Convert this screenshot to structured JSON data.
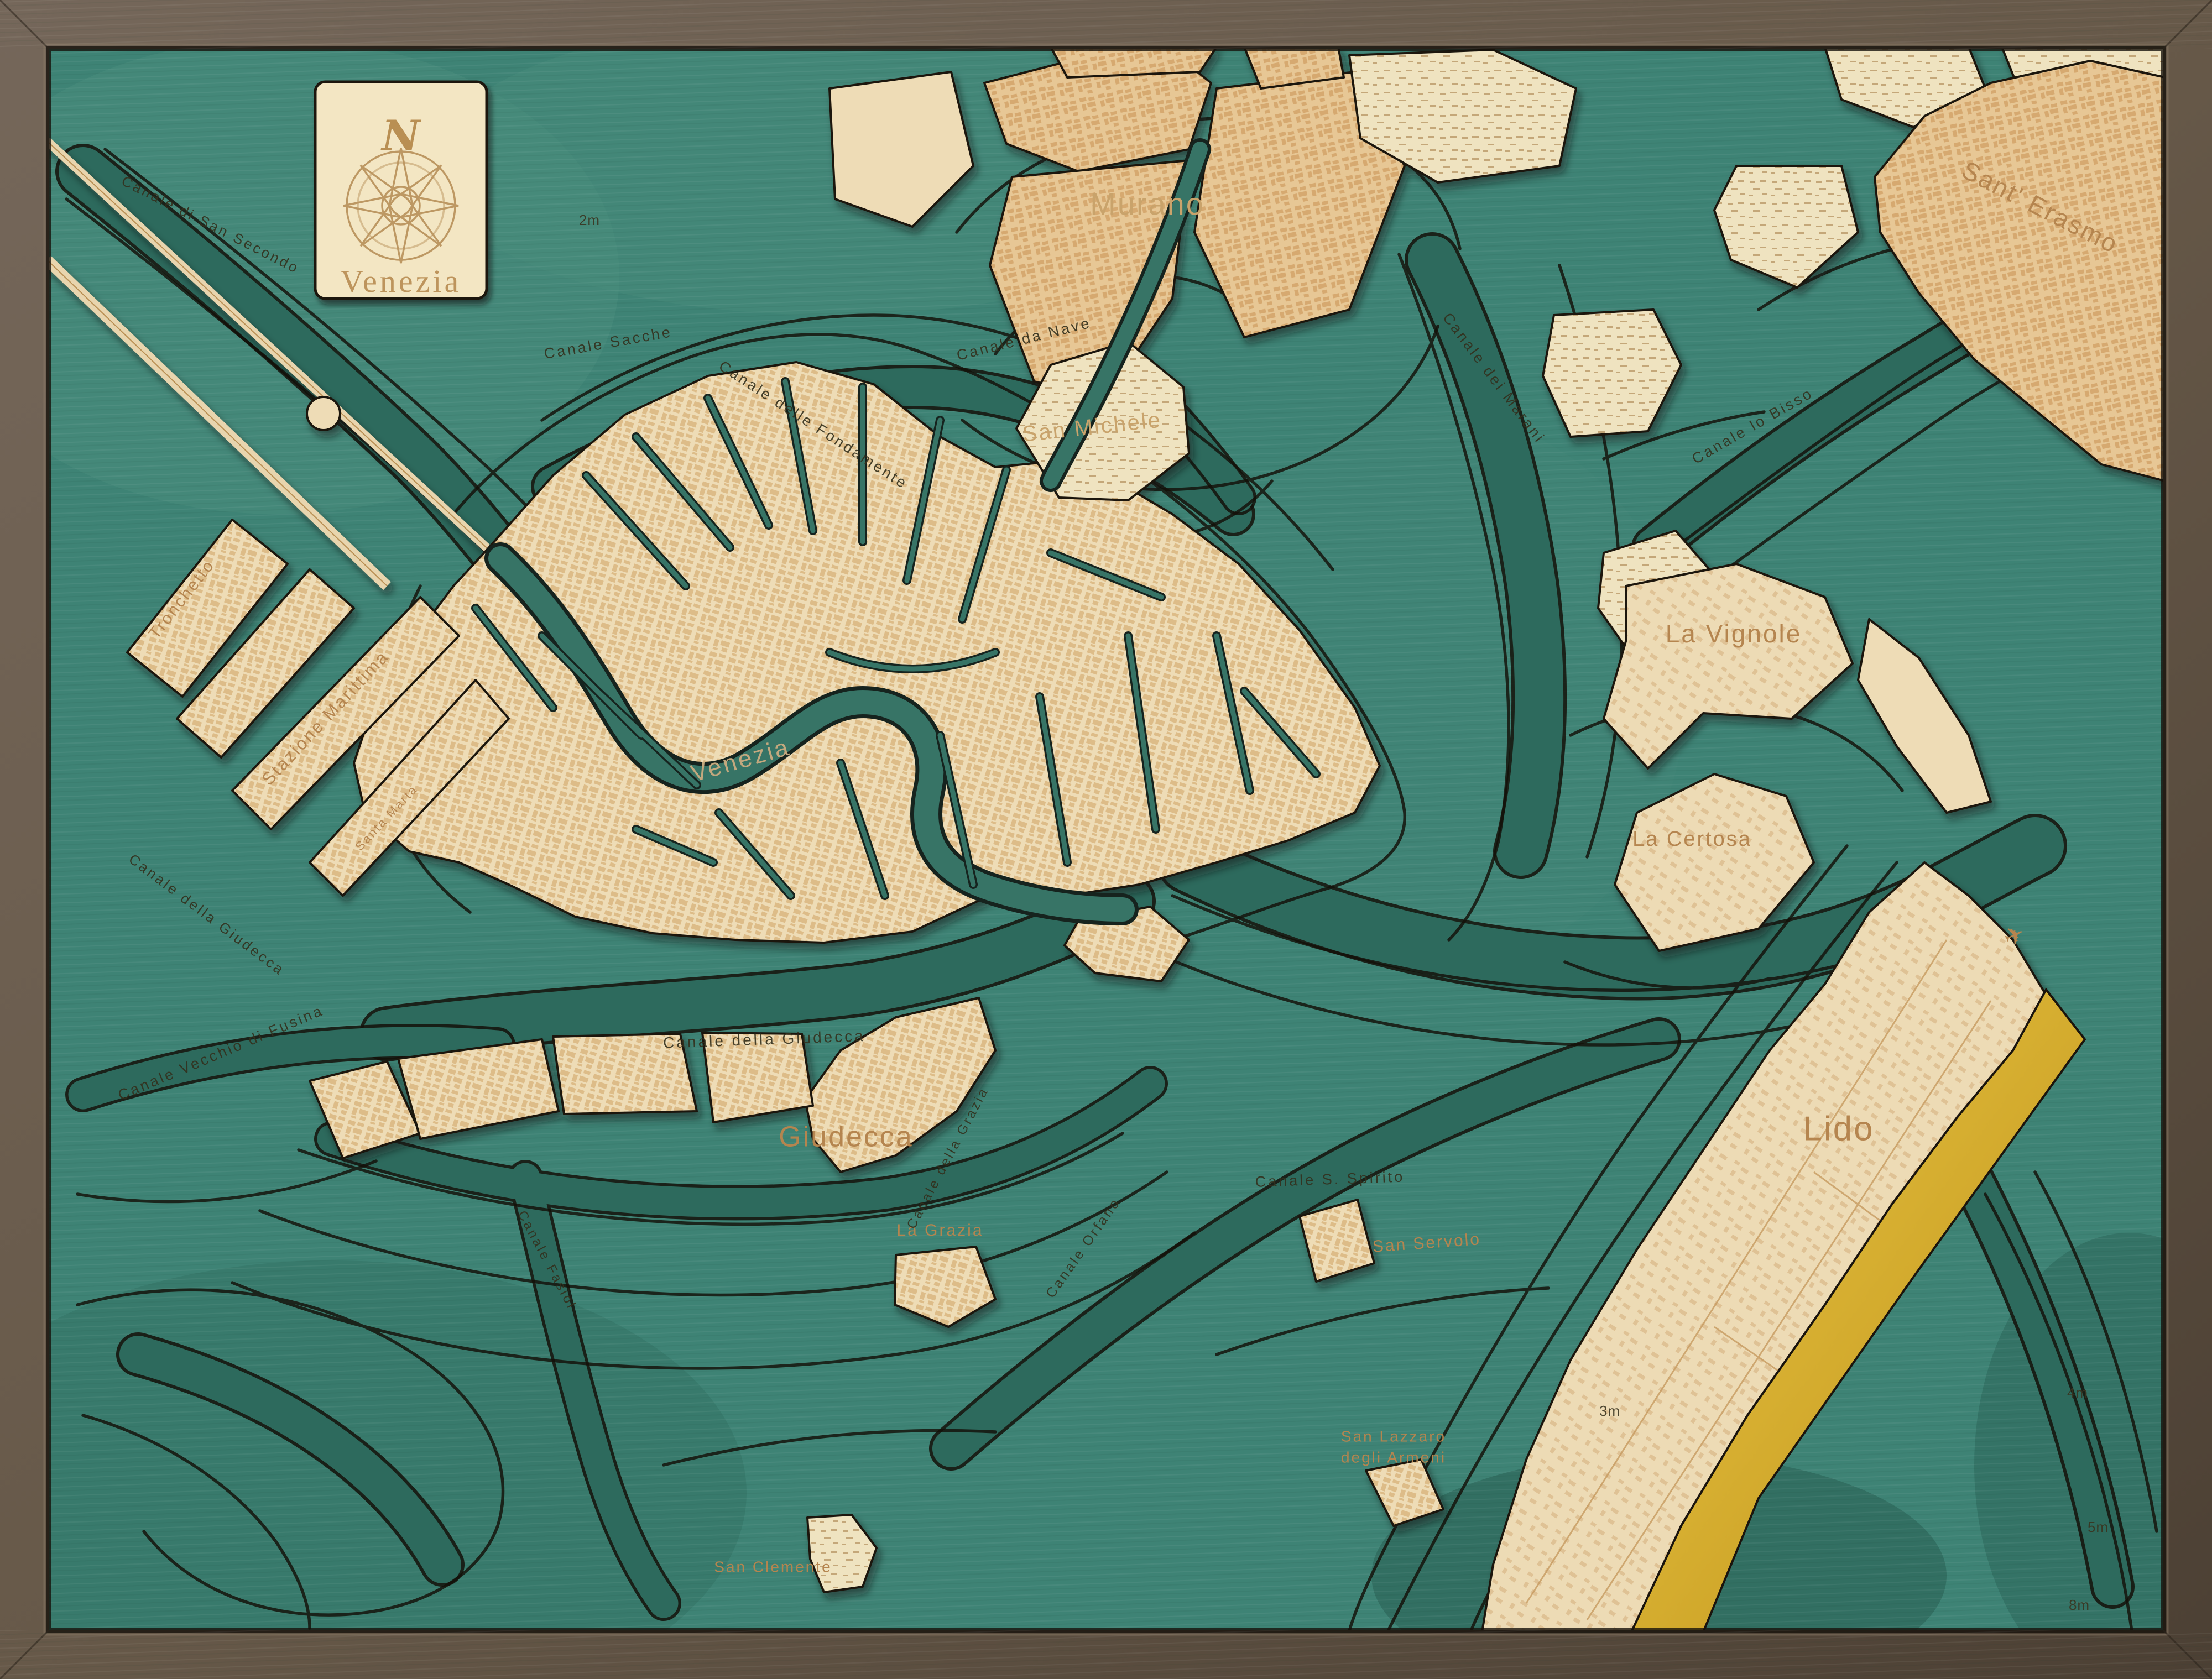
{
  "artwork_title": "Venezia",
  "title_card": {
    "north_label": "N",
    "title": "Venezia",
    "compass_icon": "compass-rose"
  },
  "icons": {
    "airplane_icon": "✈"
  },
  "palette": {
    "frame_wood": "#6a5b4b",
    "frame_wood_dark": "#4a3e33",
    "water": "#3e8375",
    "water_shallow": "#4c8f7e",
    "water_deep": "#2d6a5d",
    "water_deepest": "#265c50",
    "cut_line": "#141009",
    "land_cream": "#eedcb6",
    "land_tan": "#e7c795",
    "street_tan": "#cfa269",
    "marsh": "#efe3c0",
    "beach_gold": "#e3bd34",
    "beach_gold_deep": "#c3941b",
    "engrave_on_land": "#b5854f",
    "engrave_on_water": "#33301d",
    "engrave_light": "#c3a87e",
    "card_cream": "#f3e6c3"
  },
  "labels": {
    "places": [
      {
        "text": "Murano"
      },
      {
        "text": "San Michele"
      },
      {
        "text": "Sant' Erasmo"
      },
      {
        "text": "La Vignole"
      },
      {
        "text": "La Certosa"
      },
      {
        "text": "Lido"
      },
      {
        "text": "Giudecca"
      },
      {
        "text": "Venezia"
      },
      {
        "text": "Tronchetto"
      },
      {
        "text": "Stazione Marittima"
      },
      {
        "text": "Santa Marta"
      },
      {
        "text": "La Grazia"
      },
      {
        "text": "San Servolo"
      },
      {
        "text": "San Lazzaro"
      },
      {
        "text": "degli Armeni"
      },
      {
        "text": "San Clemente"
      }
    ],
    "canals": [
      {
        "text": "Canale di San Secondo"
      },
      {
        "text": "Canale Sacche"
      },
      {
        "text": "Canale delle Fondamente"
      },
      {
        "text": "Canale da Nave"
      },
      {
        "text": "Canale dei Marani"
      },
      {
        "text": "Canale lo Bisso"
      },
      {
        "text": "Canale della Giudecca"
      },
      {
        "text": "Canale della Giudecca"
      },
      {
        "text": "Canale Vecchio di Fusina"
      },
      {
        "text": "Canale Fasiol"
      },
      {
        "text": "Canale della Grazia"
      },
      {
        "text": "Canale Orfano"
      },
      {
        "text": "Canale S. Spirito"
      }
    ],
    "depths": [
      {
        "text": "2m"
      },
      {
        "text": "3m"
      },
      {
        "text": "4m"
      },
      {
        "text": "5m"
      },
      {
        "text": "8m"
      }
    ]
  }
}
